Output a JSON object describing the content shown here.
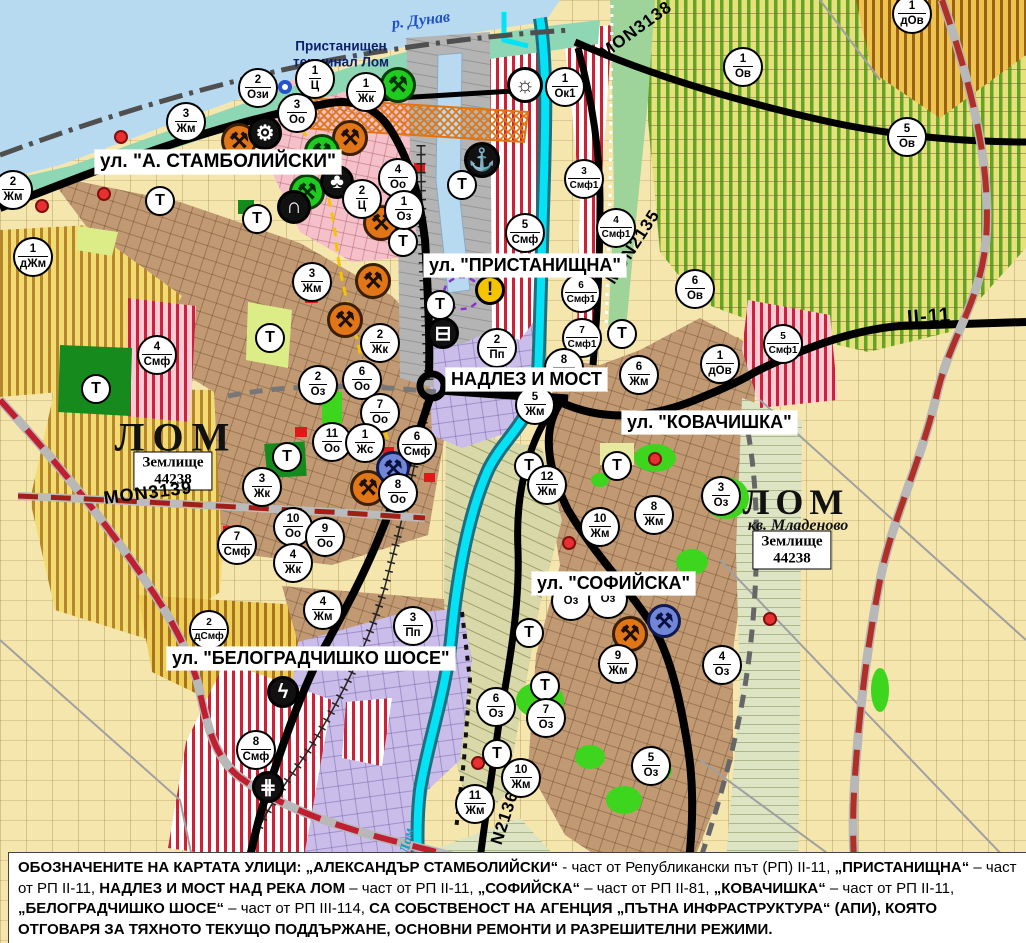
{
  "water": {
    "danube_label": "р. Дунав",
    "lom_river_label": "Лом"
  },
  "port": {
    "terminal_label_line1": "Пристанищен",
    "terminal_label_line2": "терминал Лом"
  },
  "city": {
    "name_left": "ЛОМ",
    "name_right": "ЛОМ",
    "district": "кв. Младеново",
    "land_line1": "Землище",
    "land_line2": "44238"
  },
  "t_label": "Т",
  "streets": [
    {
      "label": "ул. \"А. СТАМБОЛИЙСКИ\"",
      "x": 95,
      "y": 150,
      "fs": 19
    },
    {
      "label": "ул. \"ПРИСТАНИЩНА\"",
      "x": 424,
      "y": 254,
      "fs": 18
    },
    {
      "label": "НАДЛЕЗ И МОСТ",
      "x": 446,
      "y": 368,
      "fs": 18
    },
    {
      "label": "ул. \"КОВАЧИШКА\"",
      "x": 622,
      "y": 411,
      "fs": 18
    },
    {
      "label": "ул. \"СОФИЙСКА\"",
      "x": 532,
      "y": 572,
      "fs": 18
    },
    {
      "label": "ул. \"БЕЛОГРАДЧИШКО ШОСЕ\"",
      "x": 167,
      "y": 647,
      "fs": 18
    }
  ],
  "road_labels": [
    {
      "label": "MON3138",
      "x": 636,
      "y": 30,
      "rot": -36,
      "fs": 17
    },
    {
      "label": "MON2135",
      "x": 633,
      "y": 247,
      "rot": -57,
      "fs": 17
    },
    {
      "label": "MON3139",
      "x": 148,
      "y": 493,
      "rot": -7,
      "fs": 18
    },
    {
      "label": "N2136",
      "x": 505,
      "y": 818,
      "rot": -72,
      "fs": 17
    },
    {
      "label": "II-11",
      "x": 929,
      "y": 317,
      "rot": -4,
      "fs": 20
    }
  ],
  "markers": [
    {
      "num": "2",
      "code": "Жм",
      "x": 13,
      "y": 190
    },
    {
      "num": "1",
      "code": "дЖм",
      "x": 33,
      "y": 257
    },
    {
      "num": "3",
      "code": "Жм",
      "x": 186,
      "y": 122
    },
    {
      "num": "2",
      "code": "Ози",
      "x": 258,
      "y": 88
    },
    {
      "num": "1",
      "code": "Ц",
      "x": 315,
      "y": 79
    },
    {
      "num": "3",
      "code": "Оо",
      "x": 297,
      "y": 113
    },
    {
      "num": "1",
      "code": "Жк",
      "x": 366,
      "y": 92
    },
    {
      "num": "4",
      "code": "Оо",
      "x": 398,
      "y": 178
    },
    {
      "num": "2",
      "code": "Ц",
      "x": 362,
      "y": 199
    },
    {
      "num": "1",
      "code": "Оз",
      "x": 404,
      "y": 210
    },
    {
      "num": "1",
      "code": "Ок1",
      "x": 565,
      "y": 87
    },
    {
      "num": "3",
      "code": "Смф1",
      "x": 584,
      "y": 179
    },
    {
      "num": "4",
      "code": "Смф1",
      "x": 616,
      "y": 228
    },
    {
      "num": "5",
      "code": "Смф",
      "x": 525,
      "y": 233
    },
    {
      "num": "6",
      "code": "Смф1",
      "x": 581,
      "y": 293
    },
    {
      "num": "7",
      "code": "Смф1",
      "x": 582,
      "y": 338
    },
    {
      "num": "1",
      "code": "Ов",
      "x": 743,
      "y": 67
    },
    {
      "num": "1",
      "code": "дОв",
      "x": 912,
      "y": 14
    },
    {
      "num": "5",
      "code": "Ов",
      "x": 907,
      "y": 137
    },
    {
      "num": "6",
      "code": "Ов",
      "x": 695,
      "y": 289
    },
    {
      "num": "5",
      "code": "Смф1",
      "x": 783,
      "y": 344
    },
    {
      "num": "1",
      "code": "дОв",
      "x": 720,
      "y": 364
    },
    {
      "num": "3",
      "code": "Жм",
      "x": 312,
      "y": 282
    },
    {
      "num": "2",
      "code": "Жк",
      "x": 380,
      "y": 343
    },
    {
      "num": "6",
      "code": "Оо",
      "x": 362,
      "y": 380
    },
    {
      "num": "2",
      "code": "Оз",
      "x": 318,
      "y": 385
    },
    {
      "num": "7",
      "code": "Оо",
      "x": 380,
      "y": 413
    },
    {
      "num": "11",
      "code": "Оо",
      "x": 332,
      "y": 442
    },
    {
      "num": "1",
      "code": "Жс",
      "x": 365,
      "y": 443
    },
    {
      "num": "6",
      "code": "Смф",
      "x": 417,
      "y": 445
    },
    {
      "num": "8",
      "code": "Оо",
      "x": 398,
      "y": 493
    },
    {
      "num": "3",
      "code": "Жк",
      "x": 262,
      "y": 487
    },
    {
      "num": "10",
      "code": "Оо",
      "x": 293,
      "y": 527
    },
    {
      "num": "9",
      "code": "Оо",
      "x": 325,
      "y": 537
    },
    {
      "num": "7",
      "code": "Смф",
      "x": 237,
      "y": 545
    },
    {
      "num": "4",
      "code": "Жк",
      "x": 293,
      "y": 563
    },
    {
      "num": "4",
      "code": "Смф",
      "x": 157,
      "y": 355
    },
    {
      "num": "2",
      "code": "Пп",
      "x": 497,
      "y": 348
    },
    {
      "num": "8",
      "code": "Жм",
      "x": 564,
      "y": 368
    },
    {
      "num": "5",
      "code": "Жм",
      "x": 535,
      "y": 405
    },
    {
      "num": "6",
      "code": "Жм",
      "x": 639,
      "y": 375
    },
    {
      "num": "8",
      "code": "Жм",
      "x": 654,
      "y": 515
    },
    {
      "num": "3",
      "code": "Оз",
      "x": 721,
      "y": 496
    },
    {
      "num": "12",
      "code": "Жм",
      "x": 547,
      "y": 485
    },
    {
      "num": "10",
      "code": "Жм",
      "x": 600,
      "y": 527
    },
    {
      "num": "9",
      "code": "Жм",
      "x": 618,
      "y": 664
    },
    {
      "num": "4",
      "code": "Оз",
      "x": 722,
      "y": 665
    },
    {
      "num": "2",
      "code": "дСмф",
      "x": 209,
      "y": 630
    },
    {
      "num": "4",
      "code": "Жм",
      "x": 323,
      "y": 610
    },
    {
      "num": "3",
      "code": "Пп",
      "x": 413,
      "y": 626
    },
    {
      "num": "8",
      "code": "Смф",
      "x": 256,
      "y": 750
    },
    {
      "num": "6",
      "code": "Оз",
      "x": 496,
      "y": 707
    },
    {
      "num": "7",
      "code": "Оз",
      "x": 546,
      "y": 718
    },
    {
      "num": "10",
      "code": "Жм",
      "x": 521,
      "y": 778
    },
    {
      "num": "11",
      "code": "Жм",
      "x": 475,
      "y": 804
    },
    {
      "num": "5",
      "code": "Оз",
      "x": 651,
      "y": 766
    },
    {
      "num": "",
      "code": "Оз",
      "x": 571,
      "y": 601
    },
    {
      "num": "",
      "code": "Оз",
      "x": 608,
      "y": 599
    }
  ],
  "t_markers": [
    {
      "x": 160,
      "y": 201
    },
    {
      "x": 257,
      "y": 219
    },
    {
      "x": 270,
      "y": 338
    },
    {
      "x": 96,
      "y": 389
    },
    {
      "x": 287,
      "y": 457
    },
    {
      "x": 403,
      "y": 242
    },
    {
      "x": 440,
      "y": 305
    },
    {
      "x": 462,
      "y": 185
    },
    {
      "x": 622,
      "y": 334
    },
    {
      "x": 617,
      "y": 466
    },
    {
      "x": 529,
      "y": 466
    },
    {
      "x": 529,
      "y": 633
    },
    {
      "x": 545,
      "y": 686
    },
    {
      "x": 497,
      "y": 754
    }
  ],
  "badge_types": {
    "heritage-orange": {
      "glyph": "⚒",
      "bg": "#e07617",
      "fg": "#1d1000",
      "border": "#3a2000",
      "size": 36
    },
    "heritage-green": {
      "glyph": "⚒",
      "bg": "#1ecb1e",
      "fg": "#00300a",
      "border": "#083d08",
      "size": 36
    },
    "heritage-blue": {
      "glyph": "⚒",
      "bg": "#7286d8",
      "fg": "#0a1040",
      "border": "#101a50",
      "size": 34
    },
    "key": {
      "glyph": "⚙",
      "bg": "#111111",
      "fg": "#ffffff",
      "border": "#000000",
      "size": 34
    },
    "trefoil": {
      "glyph": "♣",
      "bg": "#111111",
      "fg": "#ffffff",
      "border": "#000000",
      "size": 34
    },
    "arch": {
      "glyph": "∩",
      "bg": "#111111",
      "fg": "#ffffff",
      "border": "#000000",
      "size": 34
    },
    "anchor": {
      "glyph": "⚓",
      "bg": "#111111",
      "fg": "#ffffff",
      "border": "#000000",
      "size": 36
    },
    "truck": {
      "glyph": "⊟",
      "bg": "#111111",
      "fg": "#ffffff",
      "border": "#000000",
      "size": 32
    },
    "lightning": {
      "glyph": "ϟ",
      "bg": "#111111",
      "fg": "#ffffff",
      "border": "#000000",
      "size": 32
    },
    "rail": {
      "glyph": "⋕",
      "bg": "#111111",
      "fg": "#ffffff",
      "border": "#000000",
      "size": 32
    },
    "sun": {
      "glyph": "☼",
      "bg": "#ffffff",
      "fg": "#111111",
      "border": "#000000",
      "size": 36
    },
    "warning": {
      "glyph": "!",
      "bg": "#f5c400",
      "fg": "#111111",
      "border": "#000000",
      "size": 30
    },
    "ring": {
      "glyph": "",
      "bg": "#ffffff",
      "fg": "#2255cc",
      "border": "#2255cc",
      "size": 14
    }
  },
  "badges": [
    {
      "type": "heritage-orange",
      "x": 239,
      "y": 141
    },
    {
      "type": "heritage-orange",
      "x": 350,
      "y": 138
    },
    {
      "type": "heritage-orange",
      "x": 381,
      "y": 223
    },
    {
      "type": "heritage-orange",
      "x": 373,
      "y": 281
    },
    {
      "type": "heritage-orange",
      "x": 345,
      "y": 320
    },
    {
      "type": "heritage-orange",
      "x": 368,
      "y": 488
    },
    {
      "type": "heritage-orange",
      "x": 630,
      "y": 634
    },
    {
      "type": "heritage-green",
      "x": 398,
      "y": 85
    },
    {
      "type": "heritage-green",
      "x": 322,
      "y": 152
    },
    {
      "type": "heritage-green",
      "x": 307,
      "y": 192
    },
    {
      "type": "heritage-blue",
      "x": 393,
      "y": 468
    },
    {
      "type": "heritage-blue",
      "x": 664,
      "y": 621
    },
    {
      "type": "key",
      "x": 265,
      "y": 133
    },
    {
      "type": "trefoil",
      "x": 337,
      "y": 182
    },
    {
      "type": "arch",
      "x": 294,
      "y": 207
    },
    {
      "type": "anchor",
      "x": 482,
      "y": 160
    },
    {
      "type": "truck",
      "x": 443,
      "y": 333
    },
    {
      "type": "lightning",
      "x": 283,
      "y": 692
    },
    {
      "type": "rail",
      "x": 268,
      "y": 787
    },
    {
      "type": "sun",
      "x": 525,
      "y": 85
    },
    {
      "type": "warning",
      "x": 490,
      "y": 290
    },
    {
      "type": "ring",
      "x": 285,
      "y": 87
    }
  ],
  "footer": {
    "segments": [
      {
        "t": "ОБОЗНАЧЕНИТЕ НА КАРТАТА УЛИЦИ: „АЛЕКСАНДЪР СТАМБОЛИЙСКИ“",
        "b": true
      },
      {
        "t": " - част от Републикански път (РП) II-11, ",
        "b": false
      },
      {
        "t": "„ПРИСТАНИЩНА“",
        "b": true
      },
      {
        "t": " – част от РП II-11, ",
        "b": false
      },
      {
        "t": "НАДЛЕЗ И МОСТ НАД РЕКА ЛОМ",
        "b": true
      },
      {
        "t": " – част от РП II-11, ",
        "b": false
      },
      {
        "t": "„СОФИЙСКА“",
        "b": true
      },
      {
        "t": " – част от РП II-81, ",
        "b": false
      },
      {
        "t": "„КОВАЧИШКА“",
        "b": true
      },
      {
        "t": " – част от РП II-11, ",
        "b": false
      },
      {
        "t": "„БЕЛОГРАДЧИШКО ШОСЕ“",
        "b": true
      },
      {
        "t": " – част от РП III-114, ",
        "b": false
      },
      {
        "t": "СА СОБСТВЕНОСТ НА АГЕНЦИЯ „ПЪТНА ИНФРАСТРУКТУРА“ (АПИ), КОЯТО ОТГОВАРЯ ЗА ТЯХНОТО ТЕКУЩО ПОДДЪРЖАНЕ, ОСНОВНИ РЕМОНТИ И РАЗРЕШИТЕЛНИ РЕЖИМИ.",
        "b": true
      }
    ]
  },
  "colors": {
    "danube": "#b7daf1",
    "coast": "#8ed7b5",
    "river_lom": "#04e2f6",
    "urban_brown": "#c19a74",
    "agri_yellow": "#f2dc72",
    "vineyard": "#e6e17b",
    "mixed_red_stripe": "#d02038",
    "industrial_lavender": "#cabde9",
    "port_gray": "#b4b4b4",
    "park_green": "#1ecb1e",
    "road_black": "#000000",
    "republican_road_red": "#c01f32"
  }
}
